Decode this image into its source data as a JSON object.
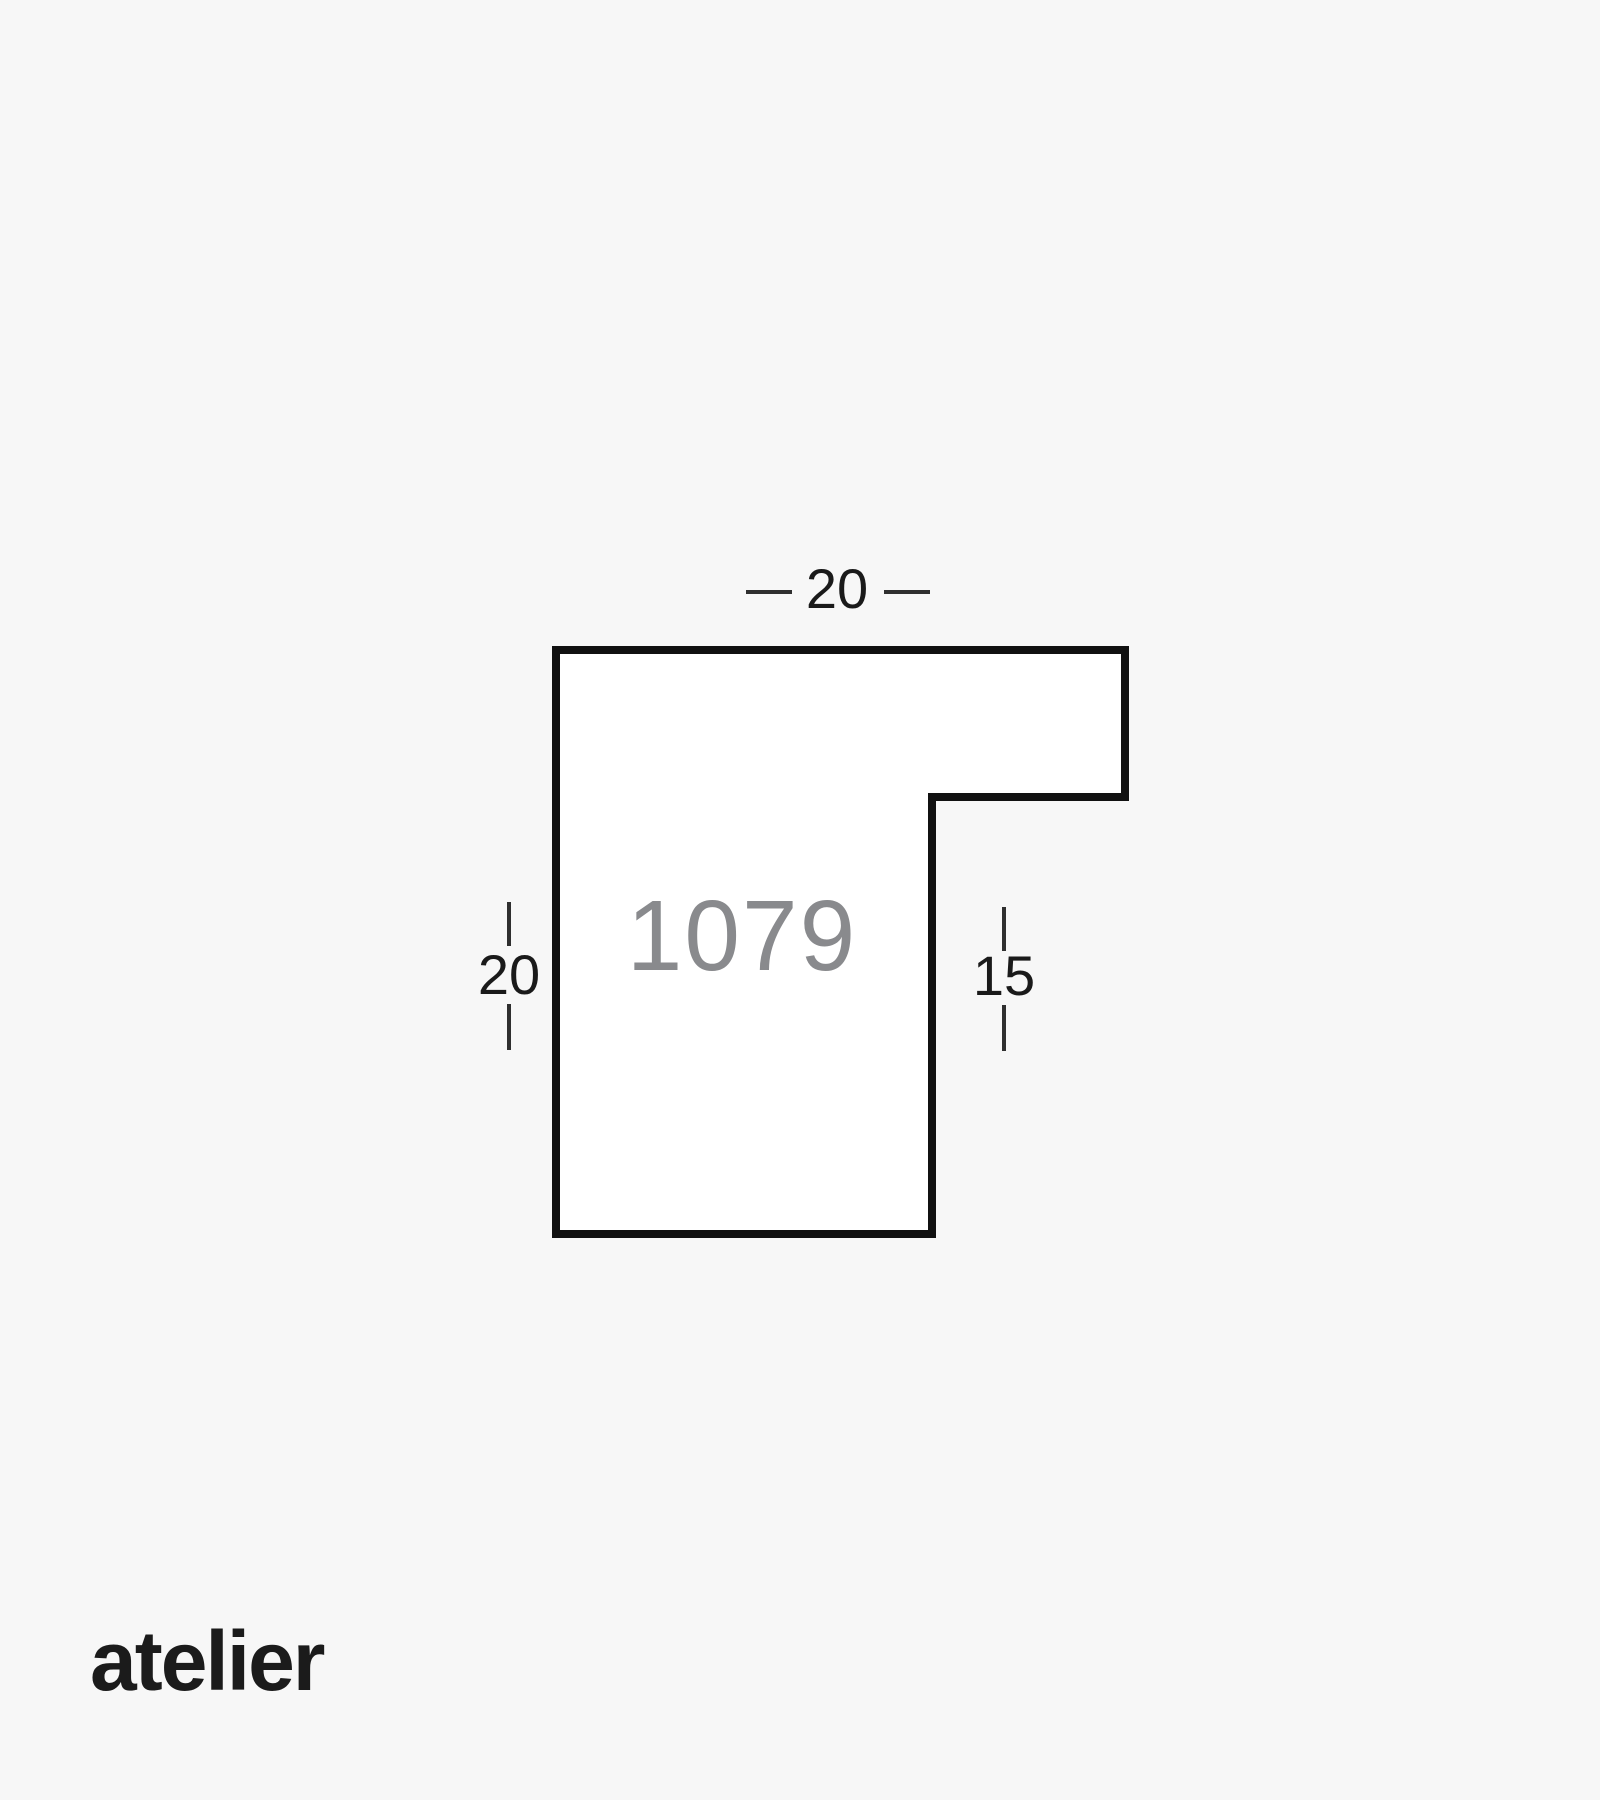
{
  "page": {
    "background_color": "#f7f7f7"
  },
  "diagram": {
    "type": "frame-moulding-profile-cross-section",
    "profile_number": "1079",
    "profile_number_color": "#898a8d",
    "outline_color": "#111111",
    "fill_color": "#ffffff",
    "tick_color": "#2f2f2f",
    "label_color": "#1a1a1a",
    "dimensions": {
      "top_width": {
        "value": "20",
        "side": "top"
      },
      "left_height": {
        "value": "20",
        "side": "left"
      },
      "right_height": {
        "value": "15",
        "side": "right"
      }
    }
  },
  "brand": {
    "wordmark": "atelier",
    "color": "#1b1b1b"
  }
}
